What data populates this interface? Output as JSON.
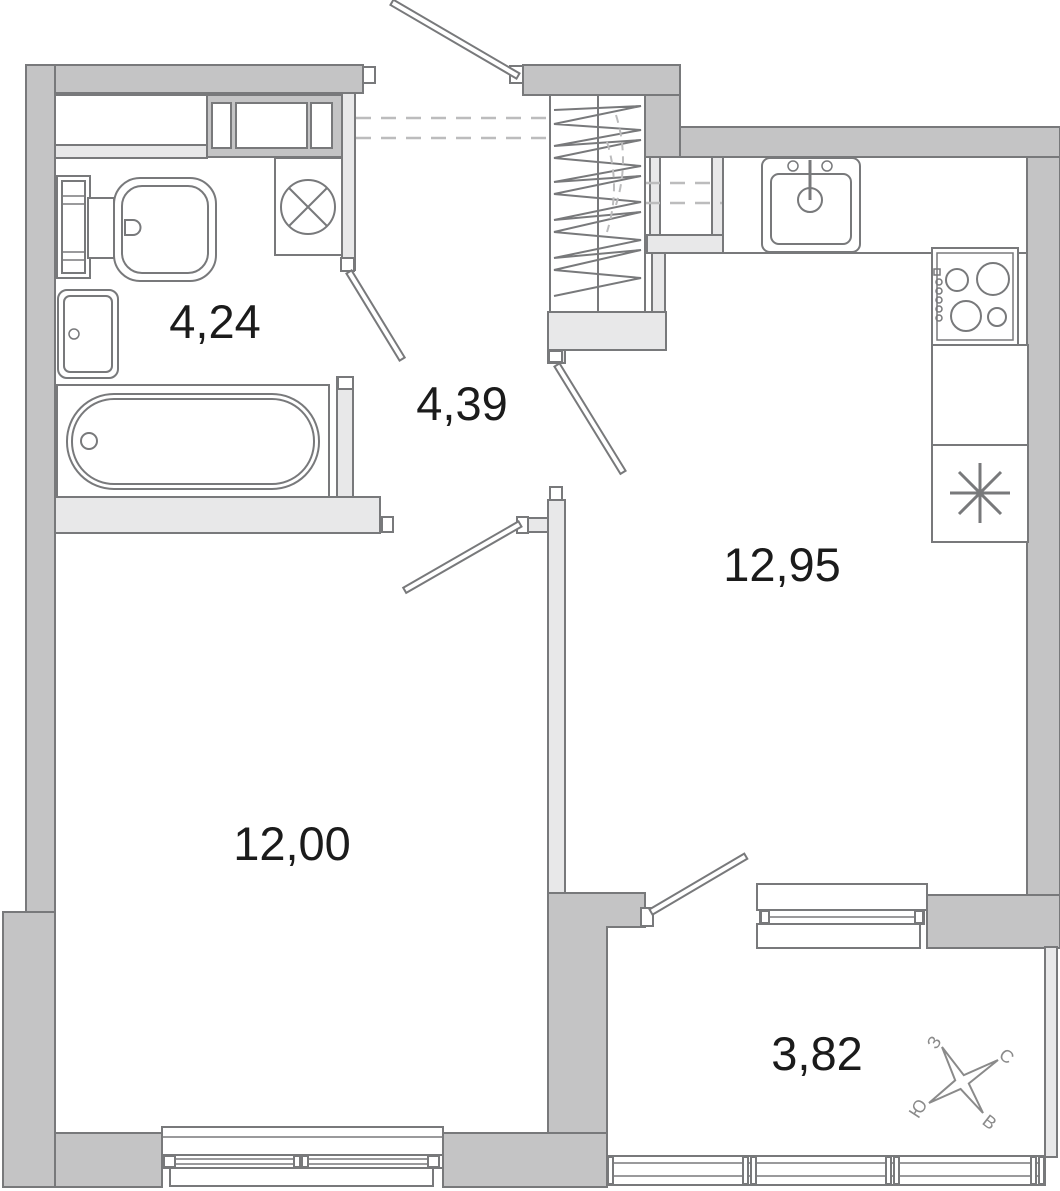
{
  "floorplan": {
    "rooms": [
      {
        "id": "bathroom",
        "area": "4,24"
      },
      {
        "id": "hallway",
        "area": "4,39"
      },
      {
        "id": "kitchen",
        "area": "12,95"
      },
      {
        "id": "living-room",
        "area": "12,00"
      },
      {
        "id": "balcony",
        "area": "3,82"
      }
    ],
    "compass": {
      "north": "С",
      "south": "Ю",
      "west": "З",
      "east": "В"
    },
    "colors": {
      "exterior_wall": "#c4c4c5",
      "interior_wall": "#e8e8e9",
      "outline": "#78797b",
      "dashed": "#bcbcbd",
      "label": "#1b1b1b",
      "compass": "#8a8a8a"
    }
  }
}
